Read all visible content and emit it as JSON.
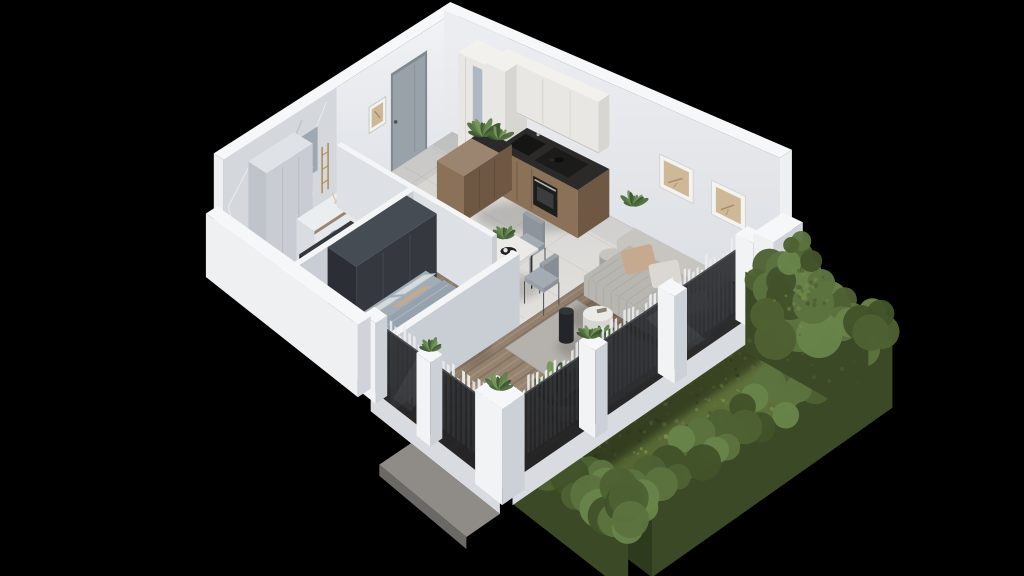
{
  "scene": {
    "background": "#000000",
    "style": "isometric-3d-cutaway-floor-plan-render",
    "rooms": [
      "hallway",
      "bathroom-laundry",
      "kitchen",
      "dining-area",
      "living-room",
      "bedroom"
    ],
    "exterior": [
      "garden-lawn",
      "boxwood-hedge",
      "shrub",
      "terrace-slab",
      "glass-facade",
      "sheer-curtains",
      "white-fence-posts"
    ],
    "furnishings": {
      "hallway": [
        "entry-door",
        "tall-closet",
        "black-console"
      ],
      "bathroom_laundry": [
        "marble-feature-wall",
        "tall-cabinets",
        "washing-machine",
        "counter-with-vase",
        "toilet",
        "gold-towel-ladder",
        "mirror-panel"
      ],
      "kitchen": [
        "white-upper-cabinets",
        "tall-cabinet",
        "wood-counter-run",
        "black-countertop",
        "sink",
        "cooktop-with-pot",
        "oven",
        "wood-peninsula",
        "potted-herbs"
      ],
      "dining_area": [
        "white-table",
        "black-serving-tray",
        "plates",
        "table-plant",
        "gray-chairs"
      ],
      "living_room": [
        "channel-tufted-sofa",
        "throw-pillows",
        "round-coffee-table-set",
        "black-side-table",
        "area-rug",
        "two-wall-art-frames",
        "potted-plants"
      ],
      "bedroom": [
        "upholstered-bed",
        "pillows",
        "throw-blanket",
        "dark-wardrobe",
        "area-rug",
        "pampas-decor"
      ]
    }
  },
  "palette": {
    "bg": "#000000",
    "wallTop": "#f6f7f8",
    "wallL_top": "#f0f2f5",
    "wallL_bot": "#d4d8de",
    "wallR_top": "#ecedf0",
    "wallR_bot": "#d8dce1",
    "wallOuter": "#eef0f2",
    "wallOuterShade": "#d0d4da",
    "partTop": "#f4f5f6",
    "partV": "#dde1e5",
    "partU": "#c9ced5",
    "tileFar": "#d3d1ce",
    "tileNear": "#edebe8",
    "tileLine": "#9a948e",
    "woodFar": "#837261",
    "woodNear": "#a28e7a",
    "woodSeam": "#5f4c3c",
    "stripeDark": "rgba(58,44,33,0.17)",
    "stripeLight": "rgba(255,243,230,0.11)",
    "marble": "#d4d8dd",
    "mStreakD": "#a9b0b8",
    "mStreakL": "#f4f6f8",
    "door": "#99a1a9",
    "doorFrame": "#81888f",
    "handle": "#4d5257",
    "glassTop": "#26282c",
    "glassBot": "#141518",
    "glassEdge": "#4a4e54",
    "curtain": "#eaecee",
    "sill": "#d8dbdf",
    "post": "#f1f3f5",
    "postShade": "#ccd1d7",
    "grassHi": "#66783f",
    "grassLo": "#4e5f2e",
    "grassD1": "#47552c",
    "grassD2": "#66793f",
    "grassD3": "#78904a",
    "grassD4": "#89a158",
    "hedgeFace": "#3b4926",
    "hedgeFaceD": "#2e3a1d",
    "blob1": "#4e6132",
    "blob2": "#5c7340",
    "blob3": "#68844a",
    "blob4": "#42522a",
    "counterTop": "#2b2a28",
    "cabWood": "#8b7158",
    "cabWoodD": "#6e5844",
    "islandTop": "#9c8570",
    "upper": "#e9e7e3",
    "upperShade": "#d8d6d1",
    "upperTop": "#f2f1ee",
    "appliance": "#1d1d1c",
    "steel": "#b9bcbe",
    "sofa": "#b8b6b1",
    "sofaShade": "#a4a29d",
    "sofaLight": "#c7c5c0",
    "pilBeige": "#c6aa90",
    "pilLight": "#dbd8d3",
    "rugLiv": "#b6b3ae",
    "rugBed": "#a9a6a1",
    "bedTop": "#a2acb5",
    "bedSide": "#8d99a4",
    "duvet": "#96a3ae",
    "pilWhite": "#d4dade",
    "throw": "#7d6f5f",
    "wardrobe": "#35393f",
    "wardrobeV": "#2b2f35",
    "wardrobeTop": "#464c54",
    "blackF": "#26282c",
    "blackFV": "#1c1e22",
    "blackFTop": "#35383e",
    "gold": "#b28d55",
    "artBeige": "#cfb897",
    "artBrown": "#9a8060",
    "frame": "#f3f3f1",
    "leaf1": "#3c5531",
    "leaf2": "#4e6c3e",
    "leaf3": "#628349",
    "leaf4": "#75975a",
    "pot": "#b4aea6",
    "slab": "#8f8c87",
    "slabD": "#6b6965",
    "white": "#eef0f2",
    "mirror": "#9aa3ad",
    "tableTop": "#eceae7",
    "chair": "#9aa0a7",
    "chairD": "#4a4f55"
  }
}
